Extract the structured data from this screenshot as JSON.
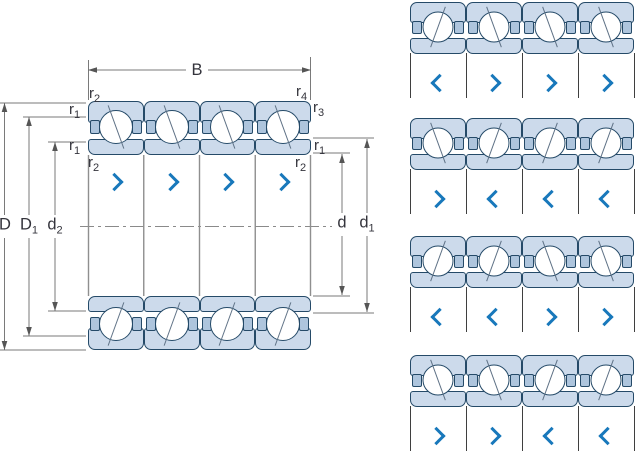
{
  "main_drawing": {
    "width_dim": {
      "label": "B"
    },
    "diameter_dims_left": [
      {
        "base": "D",
        "sub": ""
      },
      {
        "base": "D",
        "sub": "1"
      },
      {
        "base": "d",
        "sub": "2"
      }
    ],
    "diameter_dims_right": [
      {
        "base": "d",
        "sub": ""
      },
      {
        "base": "d",
        "sub": "1"
      }
    ],
    "fillet_dims": [
      {
        "position": "top-left",
        "base": "r",
        "sub": "2"
      },
      {
        "position": "top-right",
        "base": "r",
        "sub": "4"
      },
      {
        "position": "left-upper",
        "base": "r",
        "sub": "1"
      },
      {
        "position": "left-lower",
        "base": "r",
        "sub": "1"
      },
      {
        "position": "below-left",
        "base": "r",
        "sub": "2"
      },
      {
        "position": "right-upper",
        "base": "r",
        "sub": "3"
      },
      {
        "position": "right-mid",
        "base": "r",
        "sub": "1"
      },
      {
        "position": "below-right",
        "base": "r",
        "sub": "2"
      }
    ],
    "bearing_count": 4,
    "chevrons": [
      "right",
      "right",
      "right",
      "right"
    ]
  },
  "arrangement_panel": {
    "rows": [
      {
        "name": "arrangement-1",
        "chevrons": [
          "left",
          "right",
          "right",
          "right"
        ]
      },
      {
        "name": "arrangement-2",
        "chevrons": [
          "right",
          "left",
          "left",
          "left"
        ]
      },
      {
        "name": "arrangement-3",
        "chevrons": [
          "left",
          "left",
          "right",
          "right"
        ]
      },
      {
        "name": "arrangement-4",
        "chevrons": [
          "right",
          "right",
          "left",
          "left"
        ]
      }
    ]
  },
  "colors": {
    "bearing_fill": "#ccdaeb",
    "bearing_fill_dark": "#aec5dd",
    "outline": "#254a68",
    "chevron_blue": "#1878bb",
    "dimension_line": "#7a7a7a",
    "text": "#34343c"
  }
}
